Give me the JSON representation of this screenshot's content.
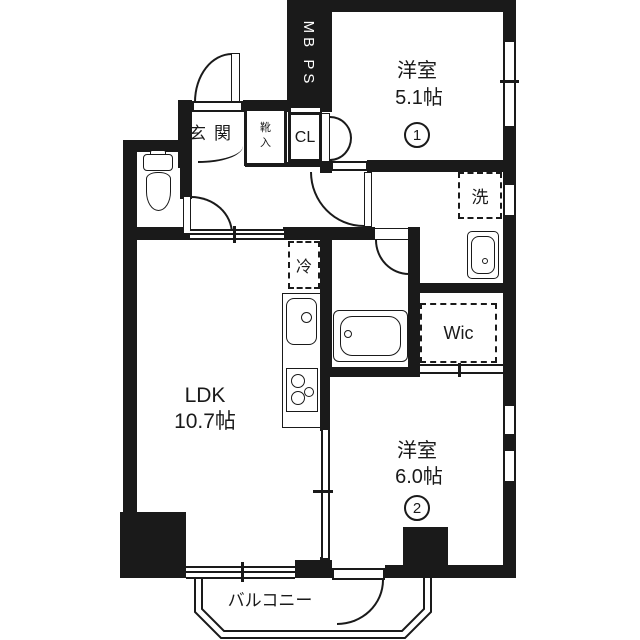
{
  "floor_plan": {
    "entrance": {
      "label": "玄関"
    },
    "shoe_cabinet": {
      "label": "靴入"
    },
    "closet": {
      "label": "CL"
    },
    "meter_box": {
      "label": "MB PS"
    },
    "western_room_1": {
      "name": "洋室",
      "size": "5.1帖",
      "number": "1"
    },
    "western_room_2": {
      "name": "洋室",
      "size": "6.0帖",
      "number": "2"
    },
    "ldk": {
      "name": "LDK",
      "size": "10.7帖"
    },
    "washer": {
      "label": "洗"
    },
    "refrigerator": {
      "label": "冷"
    },
    "walk_in_closet": {
      "label": "Wic"
    },
    "balcony": {
      "label": "バルコニー"
    },
    "colors": {
      "wall": "#1a1a1a",
      "background": "#ffffff"
    }
  }
}
